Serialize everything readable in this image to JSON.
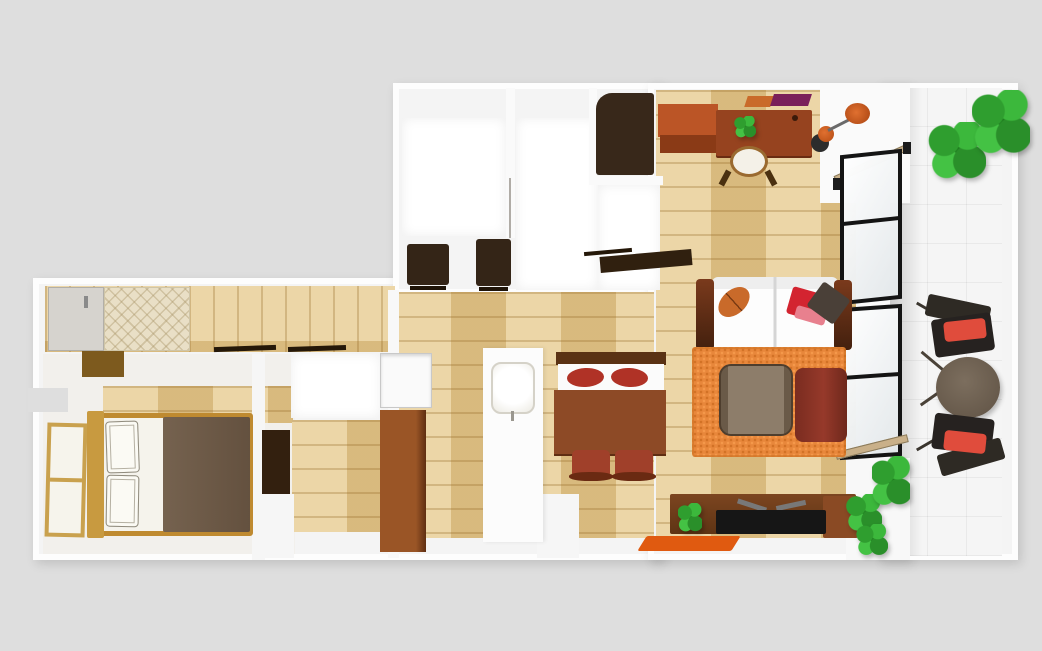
{
  "scene": {
    "background": "#dedede"
  },
  "palette": {
    "background_gray": "#dedede",
    "wall_white": "#fdfdfd",
    "wood_floor": "#e4c88e",
    "dark_furniture": "#342517",
    "desk_brown": "#96431f",
    "orange_accent": "#d2601a",
    "rug_orange": "#e8873b",
    "red_cushion": "#e04c3c",
    "sofa_arm_brown": "#5a2a16",
    "bed_wood": "#bf8a30",
    "blanket_brown": "#6d5a4c",
    "plant_green": "#2fa32f",
    "balcony_table_brown": "#6e6052"
  },
  "elements": [
    {
      "n": "left-wing-walls",
      "k": "block",
      "x": 33,
      "y": 278,
      "w": 630,
      "h": 282
    },
    {
      "n": "bathroom-block-walls",
      "k": "block",
      "x": 393,
      "y": 83,
      "w": 270,
      "h": 212
    },
    {
      "n": "living-room-walls",
      "k": "block",
      "x": 648,
      "y": 83,
      "w": 262,
      "h": 477
    },
    {
      "n": "balcony-walls",
      "k": "block",
      "x": 878,
      "y": 83,
      "w": 140,
      "h": 477
    },
    {
      "n": "hallway-floor",
      "k": "wood-v",
      "x": 45,
      "y": 286,
      "w": 350,
      "h": 66
    },
    {
      "n": "bedroom-floor",
      "x": 43,
      "y": 354,
      "w": 252,
      "h": 200,
      "c": "#f2f0ec"
    },
    {
      "n": "bedroom-floor-wood",
      "k": "wood-h",
      "x": 103,
      "y": 386,
      "w": 190,
      "h": 37
    },
    {
      "n": "closet-floor-wood",
      "k": "wood-h",
      "x": 292,
      "y": 420,
      "w": 97,
      "h": 112
    },
    {
      "n": "closet-room",
      "k": "inner-room",
      "x": 291,
      "y": 354,
      "w": 90,
      "h": 64
    },
    {
      "n": "kitchen-floor",
      "k": "wood-h",
      "x": 396,
      "y": 292,
      "w": 258,
      "h": 246
    },
    {
      "n": "living-floor",
      "k": "wood-h",
      "x": 656,
      "y": 90,
      "w": 206,
      "h": 448
    },
    {
      "n": "bathroom-floor-left",
      "k": "inner-room",
      "x": 402,
      "y": 118,
      "w": 104,
      "h": 118
    },
    {
      "n": "bathroom-floor-right",
      "k": "inner-room",
      "x": 516,
      "y": 118,
      "w": 82,
      "h": 172
    },
    {
      "n": "closet-niche-floor",
      "k": "inner-room",
      "x": 598,
      "y": 185,
      "w": 62,
      "h": 105
    },
    {
      "n": "balcony-floor-tiles",
      "k": "tile",
      "x": 888,
      "y": 88,
      "w": 114,
      "h": 468
    },
    {
      "n": "balcony-floor-shadow",
      "k": "shade-r",
      "x": 888,
      "y": 88,
      "w": 34,
      "h": 468
    },
    {
      "n": "wall-notch",
      "x": 28,
      "y": 388,
      "w": 40,
      "h": 24,
      "c": "#dedede"
    },
    {
      "n": "east-wall-strip",
      "x": 856,
      "y": 83,
      "w": 34,
      "h": 477,
      "c": "#fafafa"
    },
    {
      "n": "window-corner-top-wall",
      "x": 820,
      "y": 83,
      "w": 90,
      "h": 120,
      "c": "#fafafa"
    },
    {
      "n": "window-corner-bottom-wall",
      "x": 846,
      "y": 458,
      "w": 64,
      "h": 102,
      "c": "#f8f8f8"
    },
    {
      "n": "bathroom-divider-wall",
      "x": 506,
      "y": 88,
      "w": 9,
      "h": 150,
      "c": "#fafafa"
    },
    {
      "n": "bathroom-door-line",
      "x": 509,
      "y": 178,
      "w": 2,
      "h": 60,
      "c": "#b0aca6"
    },
    {
      "n": "bathroom-niche-wall-v",
      "x": 589,
      "y": 88,
      "w": 8,
      "h": 94,
      "c": "#fafafa"
    },
    {
      "n": "bathroom-niche-wall-h",
      "x": 589,
      "y": 176,
      "w": 74,
      "h": 9,
      "c": "#fafafa"
    },
    {
      "n": "kitchen-west-wall",
      "x": 388,
      "y": 290,
      "w": 11,
      "h": 268,
      "c": "#f8f8f8"
    },
    {
      "n": "bedroom-east-wall",
      "x": 252,
      "y": 354,
      "w": 13,
      "h": 206,
      "c": "#f6f6f6"
    },
    {
      "n": "closet-lower-wall",
      "x": 262,
      "y": 494,
      "w": 32,
      "h": 64,
      "c": "#f6f6f6"
    },
    {
      "n": "dining-lower-wall",
      "x": 537,
      "y": 494,
      "w": 42,
      "h": 64,
      "c": "#f6f6f6"
    },
    {
      "n": "entrance-door",
      "x": 48,
      "y": 287,
      "w": 56,
      "h": 64,
      "c": "#d6d3ce",
      "b": "1px solid #b2afa8"
    },
    {
      "n": "entrance-door-handle",
      "x": 84,
      "y": 296,
      "w": 4,
      "h": 12,
      "c": "#8a8a8a"
    },
    {
      "n": "entrance-mat",
      "k": "mat-tx",
      "x": 104,
      "y": 287,
      "w": 86,
      "h": 64
    },
    {
      "n": "entrance-step",
      "x": 82,
      "y": 351,
      "w": 42,
      "h": 26,
      "c": "#7d5a1e"
    },
    {
      "n": "hallway-door-rail-1",
      "x": 214,
      "y": 346,
      "w": 62,
      "h": 5,
      "c": "#241708",
      "t": "rotate(-2deg)"
    },
    {
      "n": "hallway-door-rail-2",
      "x": 288,
      "y": 346,
      "w": 58,
      "h": 5,
      "c": "#241708",
      "t": "rotate(-2deg)"
    },
    {
      "n": "shoe-shelf",
      "x": 600,
      "y": 253,
      "w": 92,
      "h": 16,
      "c": "#30200f",
      "t": "rotate(-5deg)"
    },
    {
      "n": "shoe-shelf-edge",
      "x": 584,
      "y": 250,
      "w": 48,
      "h": 4,
      "c": "#241708",
      "t": "rotate(-5deg)"
    },
    {
      "n": "bathroom-cabinet-1",
      "x": 407,
      "y": 244,
      "w": 42,
      "h": 41,
      "c": "#342517",
      "r": "3px"
    },
    {
      "n": "bathroom-cabinet-1-base",
      "x": 410,
      "y": 286,
      "w": 36,
      "h": 4,
      "c": "#1f1408"
    },
    {
      "n": "bathroom-cabinet-2",
      "x": 476,
      "y": 239,
      "w": 35,
      "h": 47,
      "c": "#342517",
      "r": "3px"
    },
    {
      "n": "bathroom-cabinet-2-base",
      "x": 479,
      "y": 287,
      "w": 29,
      "h": 4,
      "c": "#1f1408"
    },
    {
      "n": "laundry-cabinet",
      "x": 596,
      "y": 93,
      "w": 58,
      "h": 82,
      "c": "#38281a",
      "r": "16px 3px 3px 3px"
    },
    {
      "n": "bedroom-window",
      "k": "wood-window",
      "x": 46,
      "y": 423,
      "w": 40,
      "h": 114,
      "t": "rotate(1.5deg)"
    },
    {
      "n": "bed-frame",
      "x": 90,
      "y": 413,
      "w": 163,
      "h": 123,
      "c": "#f5f3ec",
      "b": "5px solid #bf8a30",
      "r": "3px"
    },
    {
      "n": "bed-headboard",
      "x": 87,
      "y": 411,
      "w": 17,
      "h": 127,
      "c": "#c89a40",
      "r": "2px"
    },
    {
      "n": "bed-blanket",
      "x": 163,
      "y": 417,
      "w": 87,
      "h": 115,
      "r": "2px",
      "g": "linear-gradient(90deg,#75624f,#64513f)"
    },
    {
      "n": "bed-pillow-1",
      "k": "sketch",
      "x": 106,
      "y": 421,
      "w": 33,
      "h": 52,
      "t": "rotate(-2deg)"
    },
    {
      "n": "bed-pillow-2",
      "k": "sketch",
      "x": 106,
      "y": 475,
      "w": 33,
      "h": 52,
      "t": "rotate(1deg)"
    },
    {
      "n": "bedroom-dresser",
      "x": 262,
      "y": 430,
      "w": 28,
      "h": 64,
      "c": "#33200f"
    },
    {
      "n": "refrigerator",
      "x": 380,
      "y": 353,
      "w": 52,
      "h": 55,
      "c": "#fafafa",
      "b": "1px solid #c8c8c8",
      "s": "inset 0 2px 3px rgba(0,0,0,.15)"
    },
    {
      "n": "kitchen-cabinet",
      "x": 380,
      "y": 410,
      "w": 46,
      "h": 142,
      "g": "linear-gradient(90deg,#9a5526 78%,#5f2f12)"
    },
    {
      "n": "kitchen-counter",
      "x": 483,
      "y": 348,
      "w": 60,
      "h": 194,
      "c": "#fcfcfc",
      "s": "2px 0 4px rgba(0,0,0,.08)"
    },
    {
      "n": "kitchen-sink",
      "x": 491,
      "y": 362,
      "w": 44,
      "h": 52,
      "r": "10px",
      "b": "2px solid #d5d2c8",
      "g": "radial-gradient(circle at 50% 45%, #ffffff 55%, #eceae2)"
    },
    {
      "n": "sink-faucet",
      "x": 511,
      "y": 411,
      "w": 3,
      "h": 10,
      "c": "#9a978f"
    },
    {
      "n": "dining-chairs-backbar",
      "x": 556,
      "y": 352,
      "w": 110,
      "h": 13,
      "c": "#5a3214"
    },
    {
      "n": "dining-bench",
      "x": 558,
      "y": 364,
      "w": 106,
      "h": 29,
      "c": "#fbfbfb"
    },
    {
      "n": "dining-cushion-left",
      "x": 567,
      "y": 368,
      "w": 37,
      "h": 19,
      "c": "#b03226",
      "r": "50%",
      "t": "rotate(-3deg)"
    },
    {
      "n": "dining-cushion-right",
      "x": 611,
      "y": 368,
      "w": 37,
      "h": 19,
      "c": "#b03226",
      "r": "50%",
      "t": "rotate(3deg)"
    },
    {
      "n": "dining-table",
      "x": 554,
      "y": 390,
      "w": 112,
      "h": 64,
      "c": "#8d4a26",
      "s": "0 2px 0 #5f2e12"
    },
    {
      "n": "dining-chair-1",
      "x": 572,
      "y": 450,
      "w": 38,
      "h": 28,
      "c": "#a0402a",
      "r": "5px"
    },
    {
      "n": "dining-chair-1-back",
      "x": 569,
      "y": 472,
      "w": 44,
      "h": 9,
      "c": "#6a2a12",
      "r": "45%"
    },
    {
      "n": "dining-chair-2",
      "x": 615,
      "y": 450,
      "w": 38,
      "h": 28,
      "c": "#a0402a",
      "r": "5px"
    },
    {
      "n": "dining-chair-2-back",
      "x": 612,
      "y": 472,
      "w": 44,
      "h": 9,
      "c": "#6a2a12",
      "r": "45%"
    },
    {
      "n": "sideboard-orange",
      "x": 658,
      "y": 104,
      "w": 60,
      "h": 33,
      "c": "#bb5526"
    },
    {
      "n": "sideboard-orange-front",
      "x": 660,
      "y": 135,
      "w": 58,
      "h": 18,
      "c": "#8a3a16"
    },
    {
      "n": "wall-shelf-orange",
      "x": 746,
      "y": 96,
      "w": 26,
      "h": 11,
      "c": "#c96a2a",
      "t": "skewX(-18deg)"
    },
    {
      "n": "wall-shelf-purple",
      "x": 772,
      "y": 94,
      "w": 38,
      "h": 12,
      "c": "#7a1f5a",
      "t": "skewX(-18deg)"
    },
    {
      "n": "desk",
      "x": 716,
      "y": 110,
      "w": 96,
      "h": 46,
      "c": "#96431f",
      "r": "2px",
      "s": "0 2px 0 #6a2c12"
    },
    {
      "n": "desk-knob",
      "x": 792,
      "y": 115,
      "w": 6,
      "h": 6,
      "c": "#3a1a0a",
      "r": "50%"
    },
    {
      "n": "desk-plant",
      "k": "plant",
      "x": 734,
      "y": 116,
      "w": 22,
      "h": 22
    },
    {
      "n": "desk-chair-cushion",
      "x": 730,
      "y": 146,
      "w": 38,
      "h": 31,
      "c": "#f4f1e8",
      "r": "50%",
      "b": "3px solid #9a6a30"
    },
    {
      "n": "desk-chair-leg-left",
      "x": 722,
      "y": 170,
      "w": 6,
      "h": 16,
      "c": "#4a3010",
      "t": "rotate(28deg)"
    },
    {
      "n": "desk-chair-leg-right",
      "x": 768,
      "y": 170,
      "w": 6,
      "h": 16,
      "c": "#4a3010",
      "t": "rotate(-28deg)"
    },
    {
      "n": "floor-lamp-base",
      "x": 811,
      "y": 134,
      "w": 18,
      "h": 18,
      "c": "#2c2c2c",
      "r": "50%"
    },
    {
      "n": "floor-lamp-bulb",
      "x": 818,
      "y": 126,
      "w": 16,
      "h": 16,
      "r": "50%",
      "g": "radial-gradient(circle at 40% 40%, #e07030, #b34a12)"
    },
    {
      "n": "floor-lamp-stem",
      "x": 828,
      "y": 129,
      "w": 36,
      "h": 3,
      "c": "#6a6a6a",
      "t": "rotate(-27deg)",
      "to": "0 50%"
    },
    {
      "n": "floor-lamp-shade",
      "x": 845,
      "y": 103,
      "w": 25,
      "h": 21,
      "r": "50%",
      "g": "radial-gradient(circle at 45% 45%, #e07030, #a84310)"
    },
    {
      "n": "window-sash-open",
      "x": 835,
      "y": 176,
      "w": 80,
      "h": 7,
      "c": "#c9b089",
      "t": "rotate(-24deg)",
      "to": "0 50%",
      "b": "1px solid #8a7a5a"
    },
    {
      "n": "window-sash-post-1",
      "x": 833,
      "y": 178,
      "w": 8,
      "h": 12,
      "c": "#1c1c1c"
    },
    {
      "n": "window-sash-post-2",
      "x": 903,
      "y": 142,
      "w": 8,
      "h": 12,
      "c": "#1c1c1c"
    },
    {
      "n": "balcony-window-top",
      "k": "glass",
      "x": 840,
      "y": 152,
      "w": 62,
      "h": 150,
      "t": "skewY(-6deg)"
    },
    {
      "n": "balcony-window-bottom",
      "k": "glass",
      "x": 840,
      "y": 306,
      "w": 62,
      "h": 152,
      "t": "skewY(-4deg)"
    },
    {
      "n": "balcony-window-rail-bottom",
      "x": 836,
      "y": 452,
      "w": 74,
      "h": 8,
      "c": "#c9b089",
      "t": "rotate(-14deg)",
      "to": "0 50%",
      "b": "1px solid #8a7a5a"
    },
    {
      "n": "sofa-body",
      "x": 712,
      "y": 277,
      "w": 126,
      "h": 73,
      "c": "#fdfdfd",
      "r": "6px",
      "g": "linear-gradient(90deg, rgba(0,0,0,0) 49%, #d5d5d5 49% 51%, rgba(0,0,0,0) 51%), linear-gradient(180deg, rgba(0,0,0,0.06) 0 12px, rgba(0,0,0,0) 12px)"
    },
    {
      "n": "sofa-arm-left",
      "x": 696,
      "y": 279,
      "w": 18,
      "h": 71,
      "r": "4px",
      "g": "linear-gradient(180deg,#7a3a1c,#43200e)"
    },
    {
      "n": "sofa-arm-right",
      "x": 834,
      "y": 280,
      "w": 18,
      "h": 70,
      "r": "4px",
      "g": "linear-gradient(180deg,#7a3a1c,#43200e)"
    },
    {
      "n": "sofa-pillow-leaf",
      "x": 716,
      "y": 290,
      "w": 36,
      "h": 24,
      "r": "50%",
      "t": "rotate(-42deg)",
      "g": "linear-gradient(90deg,#c96a2a 48%, #7a3a12 48% 52%, #c96a2a 52%)"
    },
    {
      "n": "sofa-pillow-red",
      "x": 789,
      "y": 290,
      "w": 33,
      "h": 28,
      "c": "#d32430",
      "r": "3px",
      "t": "rotate(16deg)"
    },
    {
      "n": "sofa-pillow-pink",
      "x": 795,
      "y": 309,
      "w": 31,
      "h": 13,
      "c": "#e8808e",
      "r": "3px",
      "t": "rotate(16deg)"
    },
    {
      "n": "sofa-pillow-gray",
      "x": 812,
      "y": 288,
      "w": 33,
      "h": 30,
      "c": "#4a4038",
      "r": "3px",
      "t": "rotate(36deg)"
    },
    {
      "n": "area-rug",
      "k": "rug-tx",
      "x": 692,
      "y": 347,
      "w": 154,
      "h": 110,
      "r": "3px"
    },
    {
      "n": "coffee-table",
      "x": 719,
      "y": 364,
      "w": 74,
      "h": 72,
      "r": "12px",
      "b": "2px solid #4e3e2e",
      "g": "linear-gradient(90deg,#6a5a48 0 10%, #8d7d6a 10% 90%, #6a5a48 90%)"
    },
    {
      "n": "armchair",
      "x": 795,
      "y": 368,
      "w": 52,
      "h": 74,
      "r": "8px",
      "g": "linear-gradient(90deg,#7a2c20,#96392a 55%, #6e281c)"
    },
    {
      "n": "tv-stand",
      "x": 670,
      "y": 494,
      "w": 186,
      "h": 40,
      "r": "2px",
      "g": "linear-gradient(180deg,#7c4520,#5e3414)"
    },
    {
      "n": "tv-stand-end",
      "x": 823,
      "y": 496,
      "w": 35,
      "h": 42,
      "c": "#8a4a24",
      "r": "2px"
    },
    {
      "n": "tv-plant",
      "k": "plant",
      "x": 678,
      "y": 503,
      "w": 24,
      "h": 30
    },
    {
      "n": "tv-leg-1",
      "x": 737,
      "y": 503,
      "w": 30,
      "h": 5,
      "c": "#787878",
      "t": "rotate(18deg)"
    },
    {
      "n": "tv-leg-2",
      "x": 776,
      "y": 503,
      "w": 30,
      "h": 5,
      "c": "#787878",
      "t": "rotate(-12deg)"
    },
    {
      "n": "tv-screen",
      "x": 716,
      "y": 510,
      "w": 110,
      "h": 24,
      "c": "#161616",
      "r": "2px"
    },
    {
      "n": "tv-mat",
      "x": 642,
      "y": 536,
      "w": 94,
      "h": 15,
      "c": "#e05a10",
      "t": "skewX(-32deg)",
      "r": "2px"
    },
    {
      "n": "floor-plant-1",
      "k": "plant",
      "x": 846,
      "y": 494,
      "w": 36,
      "h": 38
    },
    {
      "n": "floor-plant-2",
      "k": "plant",
      "x": 856,
      "y": 524,
      "w": 32,
      "h": 32
    },
    {
      "n": "balcony-plant-pot-1",
      "x": 944,
      "y": 132,
      "w": 14,
      "h": 14,
      "c": "#8a5a2a",
      "r": "50%"
    },
    {
      "n": "balcony-plant-pot-2",
      "x": 966,
      "y": 146,
      "w": 14,
      "h": 14,
      "c": "#8a5a2a",
      "r": "50%"
    },
    {
      "n": "balcony-plant-1",
      "k": "plant",
      "x": 928,
      "y": 122,
      "w": 58,
      "h": 58
    },
    {
      "n": "balcony-plant-2",
      "k": "plant",
      "x": 972,
      "y": 90,
      "w": 58,
      "h": 66
    },
    {
      "n": "balcony-chair-top-leg",
      "x": 915,
      "y": 308,
      "w": 26,
      "h": 3,
      "c": "#3a352e",
      "t": "rotate(30deg)"
    },
    {
      "n": "balcony-chair-top-back",
      "x": 926,
      "y": 300,
      "w": 64,
      "h": 22,
      "c": "#2e2a24",
      "t": "rotate(12deg)",
      "r": "3px"
    },
    {
      "n": "balcony-chair-top-seat",
      "x": 933,
      "y": 316,
      "w": 60,
      "h": 38,
      "c": "#262220",
      "t": "rotate(-8deg)",
      "r": "4px"
    },
    {
      "n": "balcony-chair-top-cushion",
      "x": 944,
      "y": 320,
      "w": 42,
      "h": 20,
      "c": "#e04c3c",
      "t": "rotate(-6deg)",
      "r": "4px"
    },
    {
      "n": "balcony-table-leg-1",
      "x": 918,
      "y": 360,
      "w": 30,
      "h": 3,
      "c": "#4a4238",
      "t": "rotate(40deg)"
    },
    {
      "n": "balcony-table-leg-2",
      "x": 918,
      "y": 395,
      "w": 30,
      "h": 3,
      "c": "#4a4238",
      "t": "rotate(-35deg)"
    },
    {
      "n": "balcony-table",
      "x": 936,
      "y": 357,
      "w": 64,
      "h": 61,
      "r": "50%",
      "g": "radial-gradient(circle at 45% 40%, #7c6e5e, #5f5244)",
      "s": "2px 3px 5px rgba(0,0,0,.25)"
    },
    {
      "n": "balcony-chair-bottom-leg",
      "x": 915,
      "y": 442,
      "w": 26,
      "h": 3,
      "c": "#3a352e",
      "t": "rotate(-30deg)"
    },
    {
      "n": "balcony-chair-bottom-seat",
      "x": 933,
      "y": 416,
      "w": 60,
      "h": 36,
      "c": "#262220",
      "t": "rotate(7deg)",
      "r": "4px"
    },
    {
      "n": "balcony-chair-bottom-back",
      "x": 938,
      "y": 446,
      "w": 66,
      "h": 22,
      "c": "#2e2a24",
      "t": "rotate(-16deg)",
      "r": "3px"
    },
    {
      "n": "balcony-chair-bottom-cushion",
      "x": 944,
      "y": 432,
      "w": 42,
      "h": 20,
      "c": "#e04c3c",
      "t": "rotate(6deg)",
      "r": "4px"
    },
    {
      "n": "balcony-plant-3",
      "k": "plant",
      "x": 872,
      "y": 456,
      "w": 38,
      "h": 52
    }
  ]
}
